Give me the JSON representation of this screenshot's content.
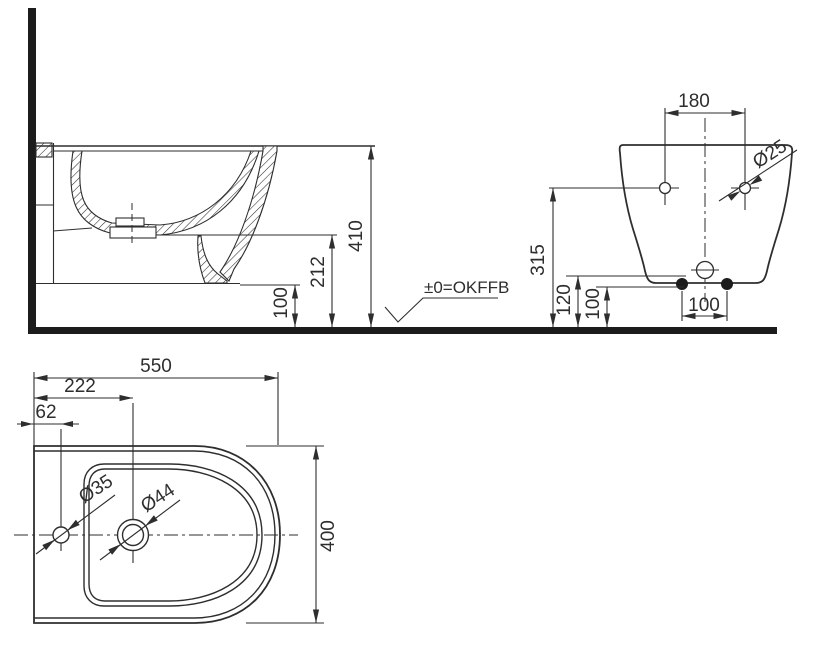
{
  "drawing": {
    "floor_label": "±0=OKFFB",
    "side_view": {
      "overall_height": "410",
      "drain_height": "212",
      "clearance_height": "100"
    },
    "front_view": {
      "hole_spacing": "180",
      "hole_diameter": "Ø25",
      "hole_height": "315",
      "drain_height": "120",
      "clearance_height": "100",
      "fixing_spacing": "100"
    },
    "plan_view": {
      "overall_length": "550",
      "tap_hole_offset": "222",
      "side_hole_offset": "62",
      "side_hole_diameter": "Ø35",
      "tap_hole_diameter": "Ø44",
      "overall_width": "400"
    },
    "colors": {
      "line": "#2e2e2e",
      "solid": "#1c1c1c"
    }
  }
}
